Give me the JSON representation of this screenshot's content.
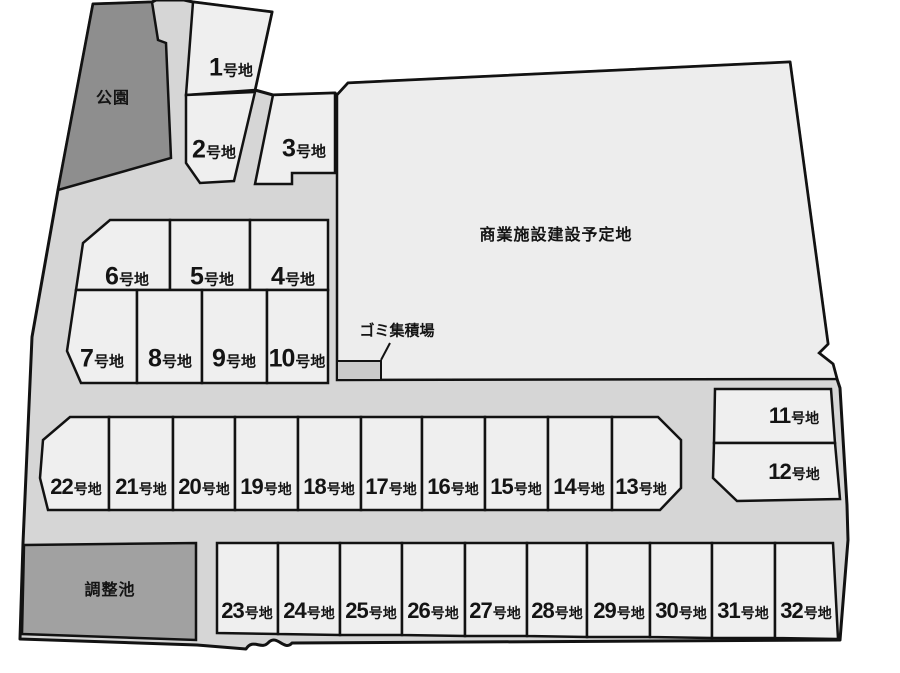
{
  "palette": {
    "background": "#ffffff",
    "road": "#d6d6d6",
    "lot": "#efefef",
    "commercial": "#ededed",
    "park": "#8e8e8e",
    "pond": "#a1a1a1",
    "garbage": "#c9c9c9",
    "outline": "#121212",
    "text": "#141414"
  },
  "labels": {
    "park": "公園",
    "pond": "調整池",
    "commercial": "商業施設建設予定地",
    "garbage": "ゴミ集積場",
    "lot_suffix": "号地"
  },
  "lots": [
    "1",
    "2",
    "3",
    "4",
    "5",
    "6",
    "7",
    "8",
    "9",
    "10",
    "11",
    "12",
    "13",
    "14",
    "15",
    "16",
    "17",
    "18",
    "19",
    "20",
    "21",
    "22",
    "23",
    "24",
    "25",
    "26",
    "27",
    "28",
    "29",
    "30",
    "31",
    "32"
  ]
}
